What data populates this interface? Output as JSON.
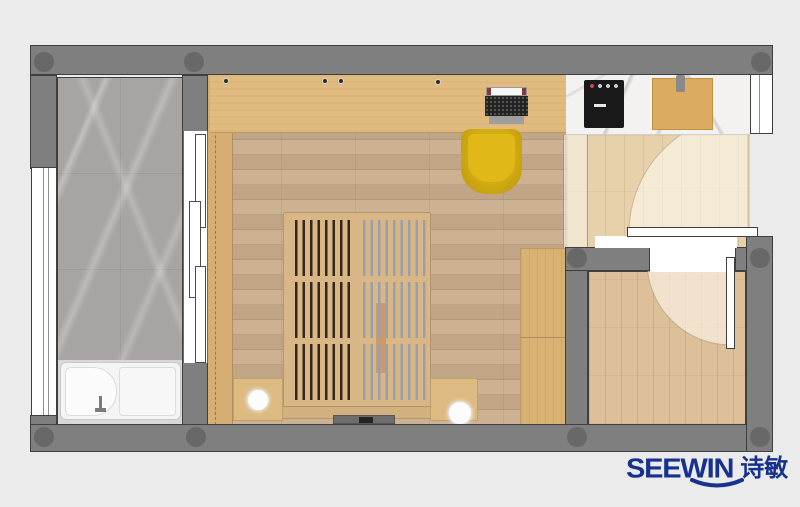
{
  "branding": {
    "logo_text": "SEEWIN",
    "logo_cn": "诗敏",
    "color": "#17328e"
  },
  "palette": {
    "bg": "#ebebeb",
    "wall": "#7f7f7f",
    "wall_outline": "#3f3f3f",
    "column": "#646464",
    "marble_floor": "#a7a4a3",
    "marble_counter": "#f3f2f0",
    "main_floor": "#c9ae8d",
    "entry_floor": "#e7d1ab",
    "room2_floor": "#ddbf99",
    "desk_wood": "#e0ba7e",
    "wardrobe_wood": "#d6ae73",
    "wardrobe_right_wood": "#d9b173",
    "bed_frame": "#d8b685",
    "bed_foot": "#d3b17e",
    "slat_dark": "#33261a",
    "slat_light": "#98a1ab",
    "chair_yellow": "#d3ac12",
    "chair_yellow_dark": "#b8950b",
    "cooktop": "#191919",
    "cutting_board": "#dcab62",
    "tub_white": "#f4f4f4",
    "bath_lower": "#d8d8d8",
    "door_wash": "rgba(255,250,240,0.6)",
    "glass_band": "rgba(250,246,238,0.55)",
    "logo": "#17328e"
  },
  "structure": {
    "rooms": [
      "bathroom",
      "main-room",
      "kitchen-counter",
      "entry",
      "secondary-room"
    ],
    "furniture": [
      "bathtub",
      "sliding-door",
      "window-left",
      "window-top-right",
      "desk",
      "monitor",
      "keyboard",
      "mouse-pad",
      "desk-chair",
      "bed",
      "bed-slats",
      "nightstand-left",
      "nightstand-right",
      "lamp-left",
      "lamp-right",
      "tv-console",
      "wardrobe-left",
      "wardrobe-right",
      "cooktop",
      "cutting-board",
      "entry-door",
      "room-door",
      "glass-partition"
    ]
  }
}
